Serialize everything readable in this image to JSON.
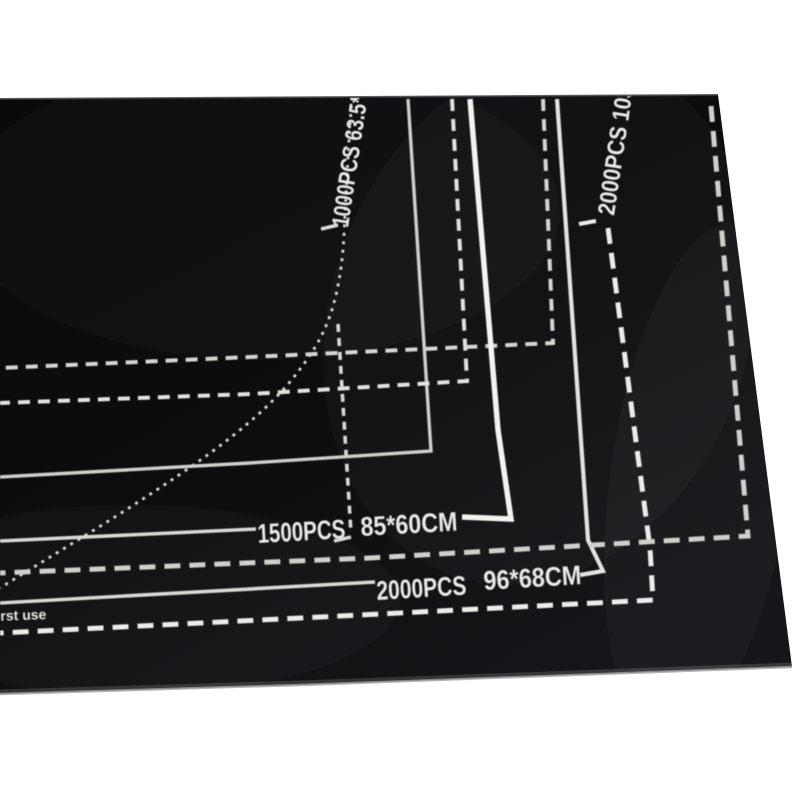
{
  "photo": {
    "subject": "black puzzle roll-up mat with printed size guides",
    "labels": {
      "size_1000": "1000PCS 63.5*",
      "size_2000_wide": "2000PCS 103",
      "size_1500_pcs": "1500PCS",
      "size_1500_dim": "85*60CM",
      "size_2000_pcs": "2000PCS",
      "size_2000_dim": "96*68CM",
      "note": "first use"
    },
    "colors": {
      "background": "#ffffff",
      "mat_dark": "#0a0a0c",
      "mat_light": "#16161a",
      "ink": "#e9e9e6",
      "edge_sheen": "#9a9a9a"
    }
  }
}
